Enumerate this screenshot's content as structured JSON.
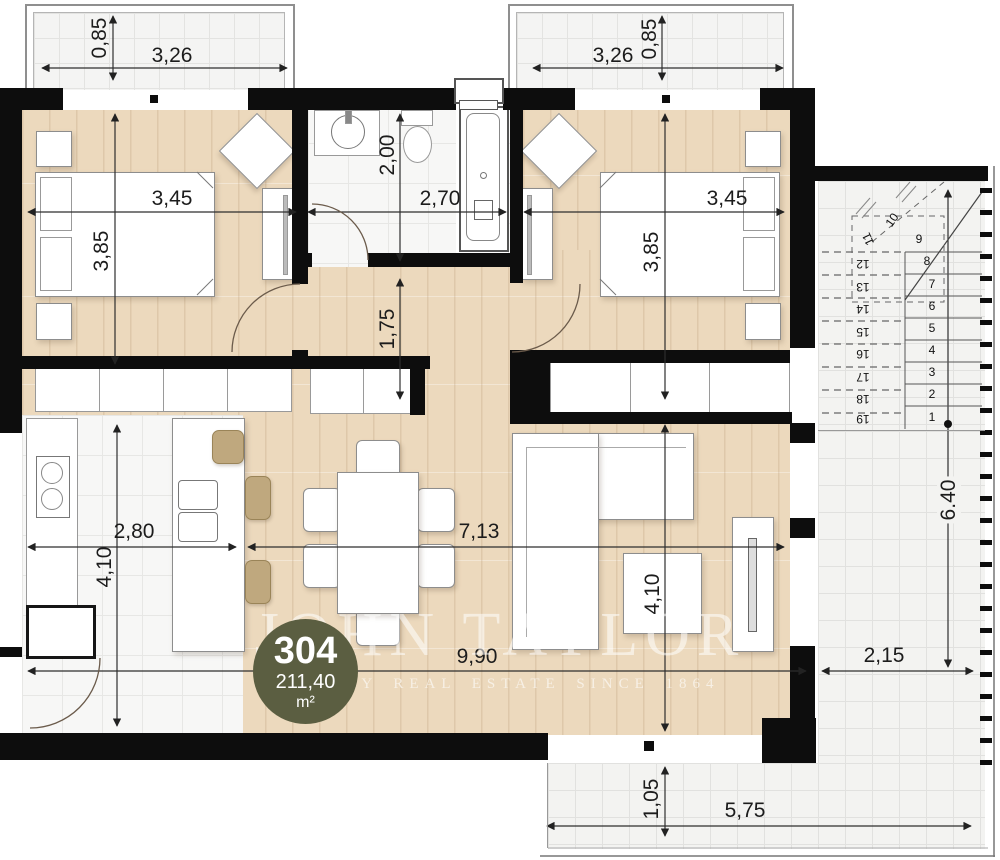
{
  "plan": {
    "unit_number": "304",
    "area_value": "211,40",
    "area_unit": "m²"
  },
  "watermark": {
    "brand": "JOHN TAYLOR",
    "tagline": "LUXURY REAL ESTATE SINCE 1864"
  },
  "dimensions": {
    "balcony_left_depth": "0,85",
    "balcony_left_width": "3,26",
    "balcony_right_width": "3,26",
    "balcony_right_depth": "0,85",
    "bedroom_left_width": "3,45",
    "bedroom_left_height": "3,85",
    "bathroom_width": "2,70",
    "bathroom_height": "2,00",
    "hallway_height": "1,75",
    "bedroom_right_width": "3,45",
    "bedroom_right_height": "3,85",
    "kitchen_width": "2,80",
    "kitchen_height": "4,10",
    "living_width": "7,13",
    "living_height": "4,10",
    "total_width": "9,90",
    "terrace_right_width": "2,15",
    "terrace_right_height": "6.40",
    "terrace_bottom_height": "1,05",
    "terrace_bottom_width": "5,75"
  },
  "stairs": {
    "steps": [
      "1",
      "2",
      "3",
      "4",
      "5",
      "6",
      "7",
      "8",
      "9",
      "10",
      "11",
      "12",
      "13",
      "14",
      "15",
      "16",
      "17",
      "18",
      "19"
    ]
  },
  "colors": {
    "wall": "#0d0d0d",
    "wood_floor": "#ecd9bd",
    "tile_floor": "#f3f3f1",
    "badge": "#5b5e41",
    "dimension_text": "#1c1c1c"
  }
}
